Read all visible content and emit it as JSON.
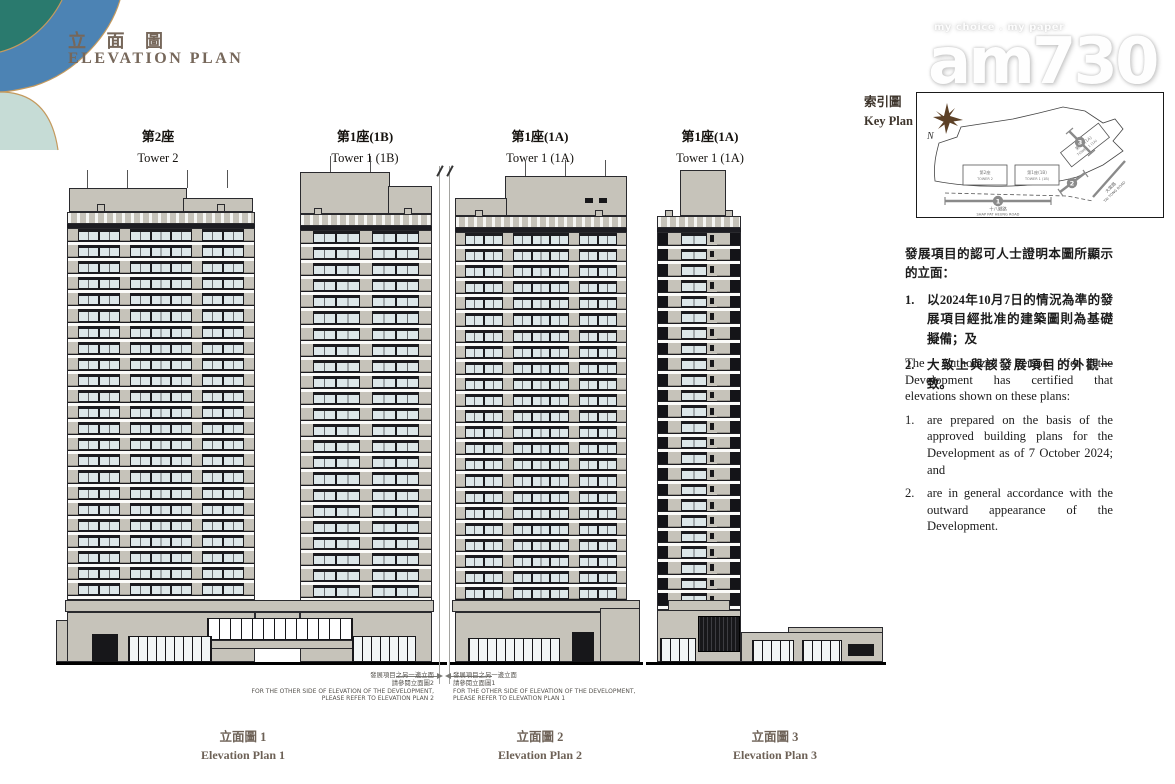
{
  "header": {
    "title_zh": "立 面 圖",
    "title_en": "ELEVATION PLAN"
  },
  "watermark": {
    "tagline": "my choice . my paper",
    "logo": "am730"
  },
  "key_plan": {
    "label_zh": "索引圖",
    "label_en": "Key Plan",
    "north": "N",
    "towers": [
      {
        "zh": "第2座",
        "en": "TOWER 2"
      },
      {
        "zh": "第1座(1B)",
        "en": "TOWER 1 (1B)"
      },
      {
        "zh": "第1座(1A)",
        "en": "TOWER 1 (1A)"
      }
    ],
    "roads": [
      {
        "zh": "十八鄉路",
        "en": "SHAP PAT HEUNG ROAD"
      },
      {
        "zh": "大棠路",
        "en": "TAI TONG ROAD"
      }
    ],
    "markers": [
      "1",
      "2",
      "3"
    ]
  },
  "certification_zh": {
    "intro": "發展項目的認可人士證明本圖所顯示的立面：",
    "item1_no": "1.",
    "item1": "以2024年10月7日的情況為準的發展項目經批准的建築圖則為基礎擬備；及",
    "item2_no": "2.",
    "item2": "大致上與該發展項目的外觀一致。"
  },
  "certification_en": {
    "intro": "The Authorized Person for the Development has certified that elevations shown on these plans:",
    "item1_no": "1.",
    "item1": "are prepared on the basis of the approved building plans for the Development as of 7 October 2024; and",
    "item2_no": "2.",
    "item2": "are in general accordance with the outward appearance of the Development."
  },
  "towers": [
    {
      "zh": "第2座",
      "en": "Tower 2"
    },
    {
      "zh": "第1座(1B)",
      "en": "Tower 1 (1B)"
    },
    {
      "zh": "第1座(1A)",
      "en": "Tower 1 (1A)"
    },
    {
      "zh": "第1座(1A)",
      "en": "Tower 1 (1A)"
    }
  ],
  "plans": [
    {
      "zh": "立面圖 1",
      "en": "Elevation Plan 1"
    },
    {
      "zh": "立面圖 2",
      "en": "Elevation Plan 2"
    },
    {
      "zh": "立面圖 3",
      "en": "Elevation Plan 3"
    }
  ],
  "notes": [
    {
      "zh1": "發展項目之另一邊立面",
      "zh2": "請參閱立面圖2",
      "en1": "FOR THE OTHER SIDE OF ELEVATION OF THE DEVELOPMENT,",
      "en2": "PLEASE REFER TO ELEVATION PLAN 2"
    },
    {
      "zh1": "發展項目之另一邊立面",
      "zh2": "請參閱立面圖1",
      "en1": "FOR THE OTHER SIDE OF ELEVATION OF THE DEVELOPMENT,",
      "en2": "PLEASE REFER TO ELEVATION PLAN 1"
    }
  ],
  "colors": {
    "accent_gold": "#c49a5e",
    "deco_teal": "#2a7a6e",
    "deco_blue": "#4c83b4",
    "deco_pale": "#c6dcd6",
    "wall_gray": "#c6c3ba",
    "glazing": "#dde7e9",
    "ink": "#17171a",
    "title_brown": "#76675a"
  }
}
